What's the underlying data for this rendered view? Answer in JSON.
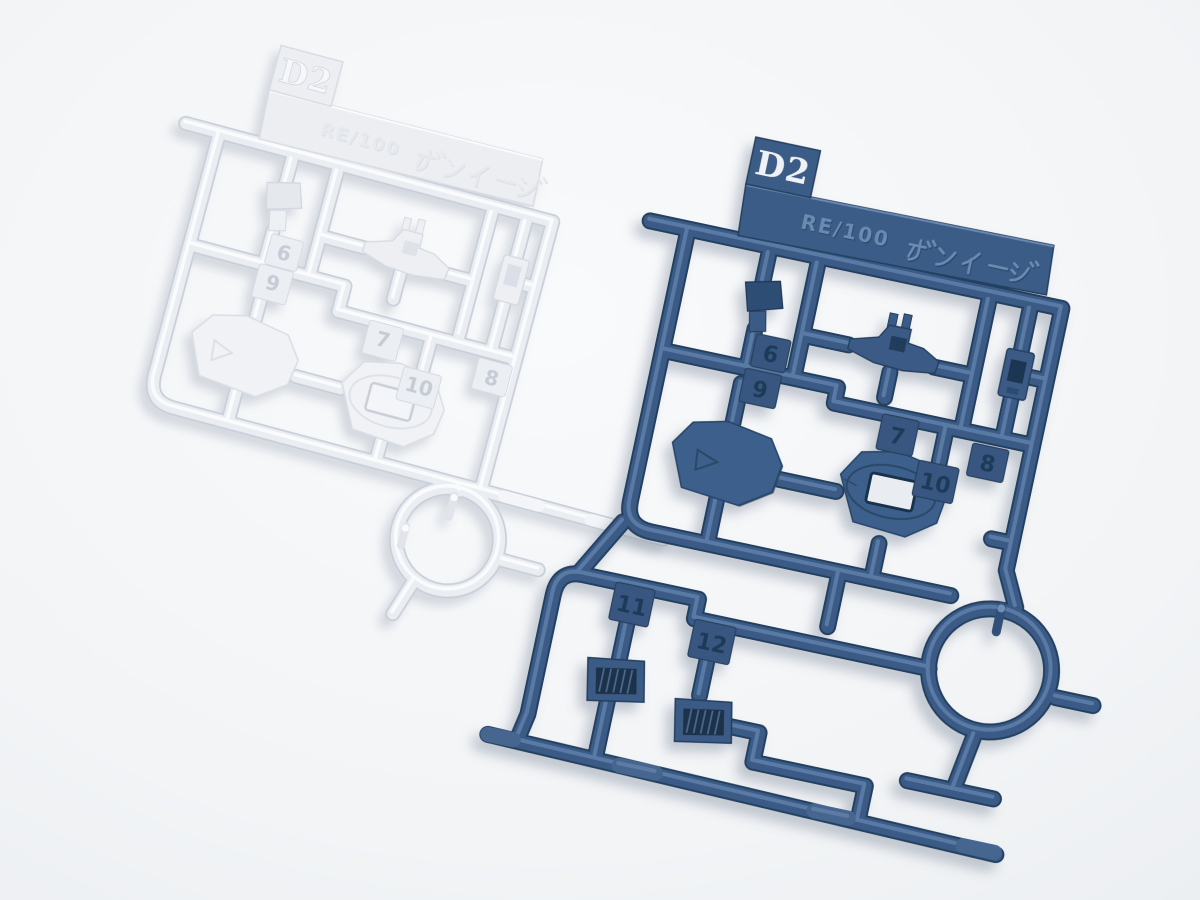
{
  "scene": {
    "type": "photograph",
    "description": "Two injection-molded plastic model-kit part runners (sprues) lying on a plain white surface: a white runner at the upper left and a dark navy-blue runner at the lower right. Both are runner D2 of the kit RE/100 GUN EZ.",
    "background_color": "#f2f4f6"
  },
  "white_runner": {
    "gate_tag": "D2",
    "plate_text": "RE/100 ガンイージ",
    "plate_text_latin": "RE/100",
    "plate_text_kana": "ガンイージ",
    "part_numbers": [
      "6",
      "9",
      "7",
      "10",
      "8"
    ],
    "plastic_color": "#eaedf1"
  },
  "blue_runner": {
    "gate_tag": "D2",
    "plate_text": "RE/100 ガンイージ",
    "plate_text_latin": "RE/100",
    "plate_text_kana": "ガンイージ",
    "part_numbers": [
      "6",
      "9",
      "7",
      "10",
      "8",
      "11",
      "12"
    ],
    "plastic_color": "#3a5a85"
  }
}
